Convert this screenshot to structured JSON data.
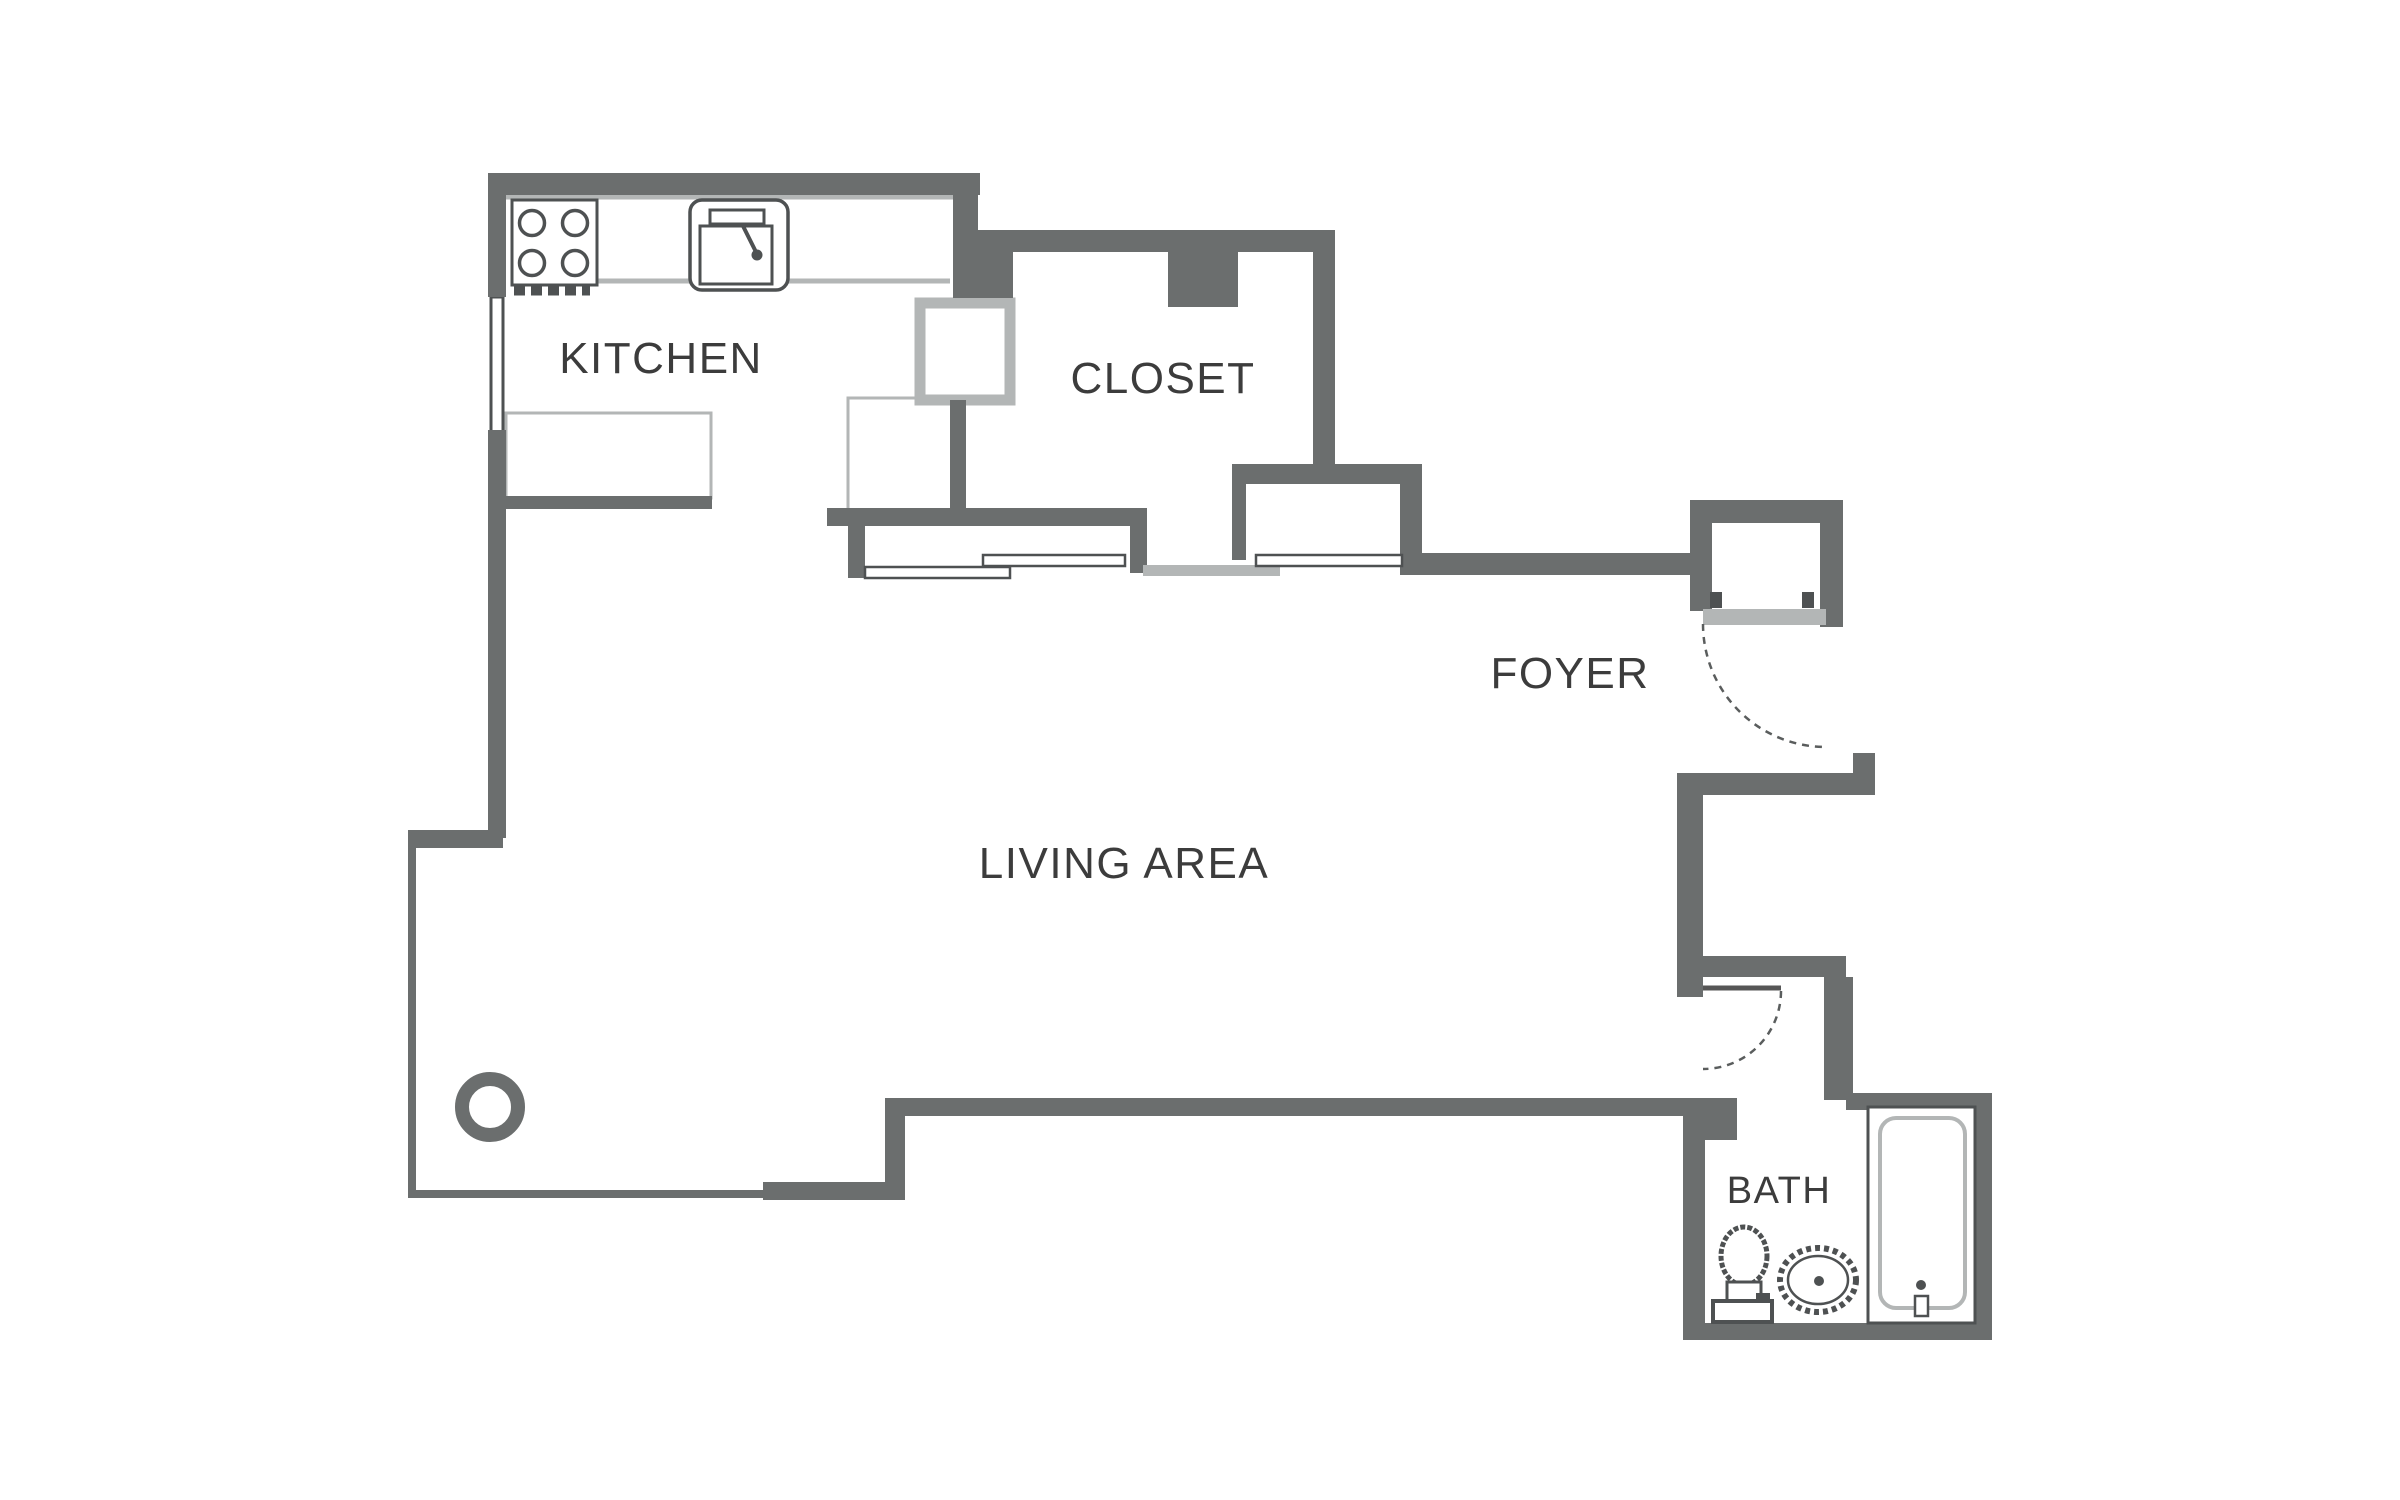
{
  "plan": {
    "title": "Studio apartment floor plan",
    "rooms": [
      {
        "id": "kitchen",
        "label": "KITCHEN"
      },
      {
        "id": "closet",
        "label": "CLOSET"
      },
      {
        "id": "foyer",
        "label": "FOYER"
      },
      {
        "id": "living-area",
        "label": "LIVING AREA"
      },
      {
        "id": "bath",
        "label": "BATH"
      }
    ],
    "fixtures": [
      "stove-icon",
      "kitchen-sink-icon",
      "pass-through-cabinet",
      "counter",
      "refrigerator",
      "window",
      "sliding-closet-doors",
      "entry-door-swing-arc",
      "bath-door-swing-arc",
      "toilet-icon",
      "bath-sink-icon",
      "bathtub-icon",
      "column-icon"
    ],
    "colors": {
      "wall": "#6b6e6e",
      "counter_light": "#b3b6b6",
      "fixture": "#4e5152",
      "label": "#3c3c3c",
      "background": "#ffffff"
    }
  }
}
